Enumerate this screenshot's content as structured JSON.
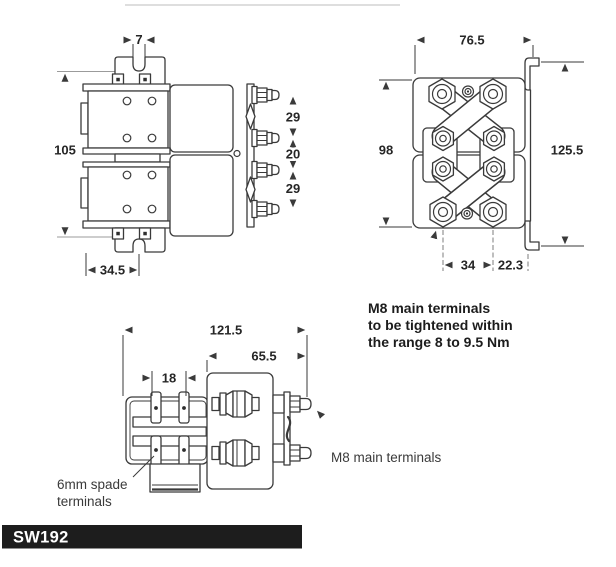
{
  "side_view": {
    "slot_width": "7",
    "overall_height": "105",
    "terminal_pitch_upper": "29",
    "terminal_pitch_middle": "20",
    "terminal_pitch_lower": "29",
    "bracket_offset": "34.5"
  },
  "front_view": {
    "overall_width": "76.5",
    "body_height": "98",
    "bracket_height": "125.5",
    "terminal_spacing": "34",
    "bracket_offset": "22.3",
    "torque_note_line1": "M8 main terminals",
    "torque_note_line2": "to be tightened within",
    "torque_note_line3": "the range 8 to 9.5 Nm"
  },
  "top_view": {
    "overall_depth": "121.5",
    "body_depth": "65.5",
    "spade_pitch": "18",
    "spade_label_line1": "6mm spade",
    "spade_label_line2": "terminals",
    "terminal_label": "M8 main terminals"
  },
  "banner": {
    "model": "SW192"
  },
  "colors": {
    "line": "#3a3a3a",
    "dim_text": "#262626",
    "banner_bg": "#1d1d1d",
    "banner_text": "#ffffff",
    "background": "#ffffff"
  }
}
